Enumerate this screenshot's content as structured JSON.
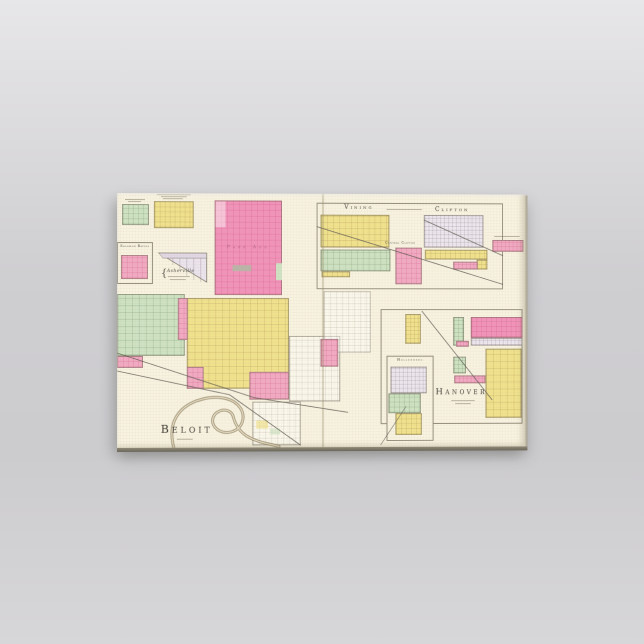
{
  "product": {
    "kind": "gallery-wrapped canvas print mockup",
    "scene": "vintage county atlas plate of Kansas town plats displayed on a wall"
  },
  "palette": {
    "bg_top": "#e7e6e8",
    "bg_mid": "#cfced1",
    "bg_mid2": "#cccbce",
    "bg_bottom": "#d7d6d8",
    "canvas_cream": "#f8f3e1",
    "c_yellow": "#f1e38c",
    "c_green": "#cee3c3",
    "c_pink": "#f3a9c3",
    "c_pink_deep": "#f292ba",
    "c_lavender": "#ede7ef",
    "c_river": "#9b8e72",
    "c_line": "#55504a"
  },
  "map": {
    "labels": {
      "beloit": "Beloit",
      "vining": "Vining",
      "clifton": "Clifton",
      "central_clifton": "Central Clifton",
      "hanover": "Hanover",
      "hollenberg": "Hollenberg",
      "park_add": "Park Add",
      "solomon_rapids": "Solomon Rapids",
      "asherville": "Asherville",
      "asherville_brace": "{"
    }
  }
}
